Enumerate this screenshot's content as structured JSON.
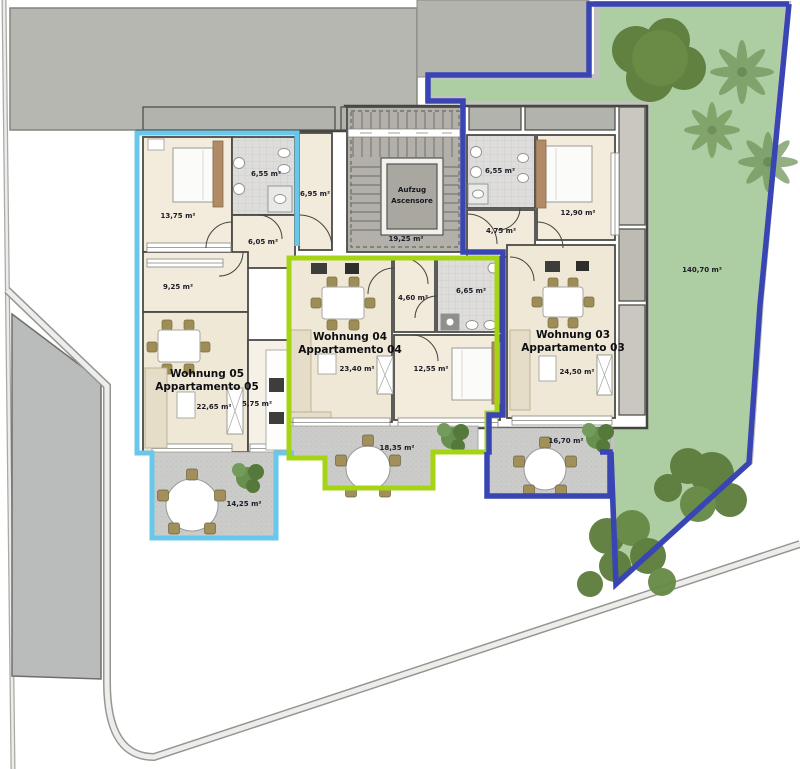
{
  "plan": {
    "garden": {
      "area": "140,70 m²",
      "fill": "#adcda2",
      "border": "#3a45b4"
    },
    "stairwell": {
      "area": "19,25 m²",
      "elevator_line1": "Aufzug",
      "elevator_line2": "Ascensore"
    },
    "corridor": {
      "area": "6,95 m²"
    },
    "apartments": {
      "apt05": {
        "name_de": "Wohnung 05",
        "name_it": "Appartamento 05",
        "accent": "#68c7ea",
        "rooms": {
          "bedroom": "13,75 m²",
          "bathroom": "6,55 m²",
          "hall": "6,05 m²",
          "study": "9,25 m²",
          "living": "22,65 m²",
          "kitchen": "5,75 m²",
          "terrace": "14,25 m²"
        }
      },
      "apt04": {
        "name_de": "Wohnung 04",
        "name_it": "Appartamento 04",
        "accent": "#a4d414",
        "rooms": {
          "living": "23,40 m²",
          "hall": "4,60 m²",
          "bathroom": "6,65 m²",
          "bedroom": "12,55 m²",
          "terrace": "18,35 m²"
        }
      },
      "apt03": {
        "name_de": "Wohnung 03",
        "name_it": "Appartamento 03",
        "accent": "#3a45b4",
        "rooms": {
          "bathroom": "6,55 m²",
          "bedroom": "12,90 m²",
          "hall": "4,75 m²",
          "living": "24,50 m²",
          "terrace": "16,70 m²"
        }
      }
    }
  }
}
